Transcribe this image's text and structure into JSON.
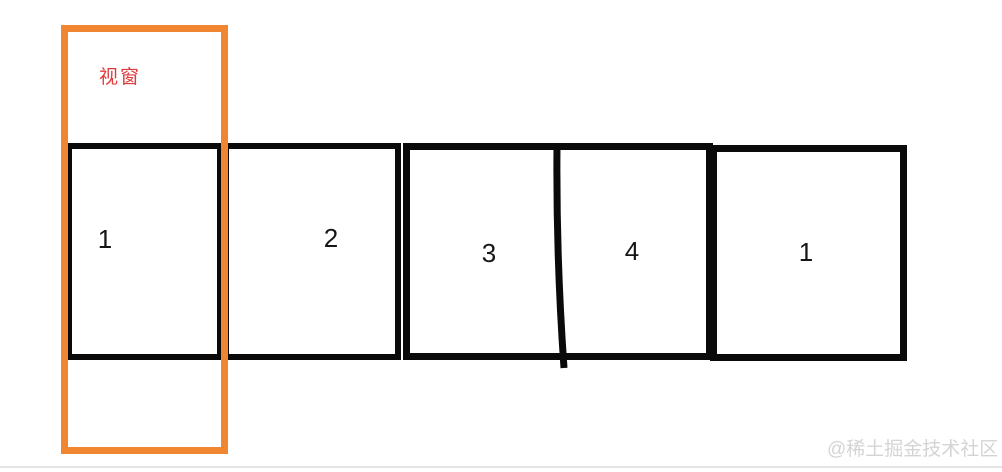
{
  "diagram": {
    "viewport_label": "视窗",
    "slides": [
      {
        "label": "1"
      },
      {
        "label": "2"
      },
      {
        "label": "3"
      },
      {
        "label": "4"
      },
      {
        "label": "1"
      }
    ],
    "watermark": "@稀土掘金技术社区",
    "colors": {
      "viewport_border": "#F0862F",
      "viewport_label": "#E03A3C",
      "box_border": "#0A0A0A",
      "watermark": "#D4D4D4",
      "bottom_rule": "#E4E4E4"
    }
  }
}
